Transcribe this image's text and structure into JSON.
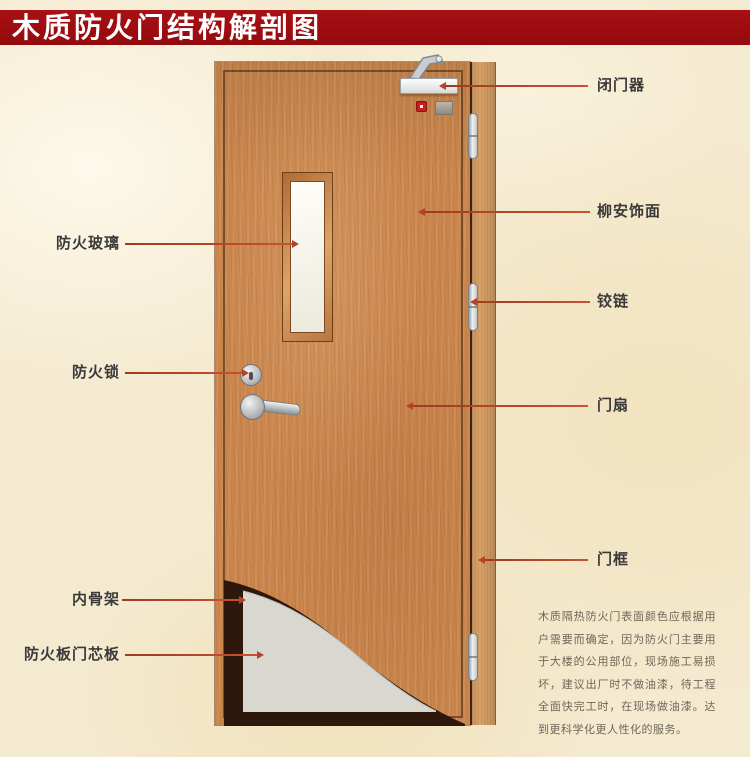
{
  "title": "木质防火门结构解剖图",
  "callouts": {
    "fire_glass": "防火玻璃",
    "fire_lock": "防火锁",
    "inner_skeleton": "内骨架",
    "fire_board_core": "防火板门芯板",
    "door_closer": "闭门器",
    "lauan_veneer": "柳安饰面",
    "hinge": "铰链",
    "door_leaf": "门扇",
    "door_frame": "门框"
  },
  "description": "木质隔热防火门表面颜色应根据用户需要而确定，因为防火门主要用于大楼的公用部位，现场施工易损坏，建议出厂时不做油漆，待工程全面快完工时，在现场做油漆。达到更科学化更人性化的服务。",
  "colors": {
    "banner_red": "#9c0d10",
    "background_cream": "#f4ead0",
    "door_wood": "#c9854c",
    "frame_wood": "#d9a369",
    "skeleton_dark": "#2e180c",
    "core_panel_gray": "#d8d7d0",
    "pointer_line": "#b5432a",
    "label_text": "#3a3a3a"
  }
}
